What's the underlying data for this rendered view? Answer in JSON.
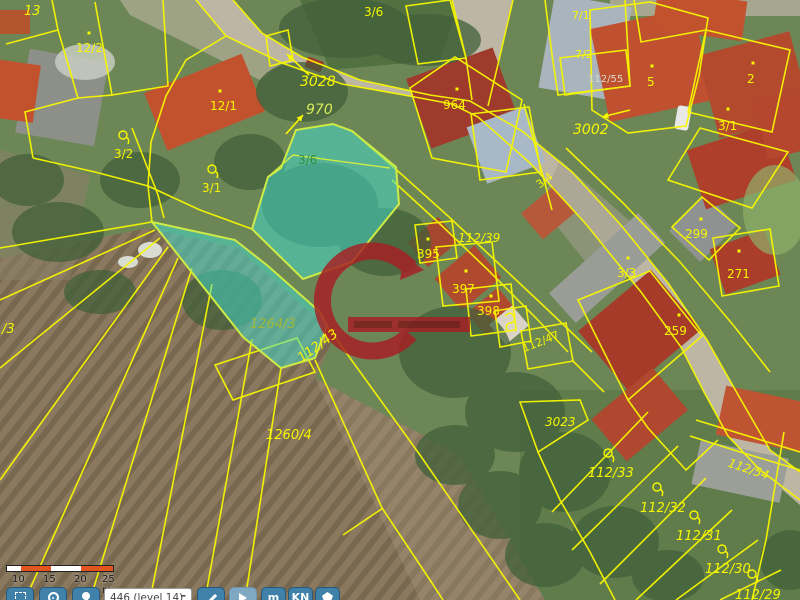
{
  "colors": {
    "parcel_line": "#f7f700",
    "highlight_fill": "#3fe0cf",
    "highlight_stroke": "#cdea45",
    "toolbar_button": "#3f81a8",
    "scalebar_orange": "#e2551f",
    "watermark_red": "#a81e23"
  },
  "scalebar": {
    "ticks": [
      "10",
      "15",
      "20",
      "25 m"
    ]
  },
  "toolbar": {
    "level_label": "446 (level 14)",
    "minus_label": "–",
    "m_label": "m",
    "kn_label": "KN"
  },
  "map": {
    "labels": [
      {
        "t": "13",
        "x": 24,
        "y": 2,
        "size": 13,
        "italic": true
      },
      {
        "t": "12/2",
        "x": 76,
        "y": 40,
        "size": 12,
        "dot": [
          89,
          33
        ]
      },
      {
        "t": "12/1",
        "x": 210,
        "y": 98,
        "size": 12,
        "dot": [
          220,
          91
        ]
      },
      {
        "t": "3/2",
        "x": 114,
        "y": 146,
        "size": 12,
        "balloon": [
          123,
          135
        ]
      },
      {
        "t": "3/1",
        "x": 202,
        "y": 180,
        "size": 12,
        "balloon": [
          212,
          169
        ]
      },
      {
        "t": "3/6",
        "x": 364,
        "y": 4,
        "size": 12
      },
      {
        "t": "3028",
        "x": 300,
        "y": 72,
        "size": 14,
        "italic": true
      },
      {
        "t": "970",
        "x": 306,
        "y": 100,
        "size": 14,
        "italic": true,
        "color": "#d8ea5c"
      },
      {
        "t": "3/6",
        "x": 298,
        "y": 152,
        "size": 12,
        "color": "#2f8f3a"
      },
      {
        "t": "964",
        "x": 443,
        "y": 97,
        "size": 12,
        "dot": [
          457,
          89
        ]
      },
      {
        "t": "7/1",
        "x": 572,
        "y": 8,
        "size": 11
      },
      {
        "t": "7/2",
        "x": 575,
        "y": 47,
        "size": 11
      },
      {
        "t": "112/55",
        "x": 588,
        "y": 72,
        "size": 10,
        "color": "#d9dcc9"
      },
      {
        "t": "5",
        "x": 647,
        "y": 74,
        "size": 12,
        "dot": [
          652,
          66
        ]
      },
      {
        "t": "2",
        "x": 747,
        "y": 71,
        "size": 12,
        "dot": [
          753,
          63
        ]
      },
      {
        "t": "3/1",
        "x": 718,
        "y": 118,
        "size": 12,
        "dot": [
          728,
          109
        ]
      },
      {
        "t": "3002",
        "x": 573,
        "y": 120,
        "size": 14,
        "italic": true
      },
      {
        "t": "3/4",
        "x": 533,
        "y": 180,
        "size": 11,
        "rot": -38
      },
      {
        "t": "112/39",
        "x": 458,
        "y": 230,
        "size": 12,
        "italic": true
      },
      {
        "t": "395",
        "x": 417,
        "y": 246,
        "size": 12,
        "dot": [
          428,
          239
        ]
      },
      {
        "t": "397",
        "x": 452,
        "y": 281,
        "size": 12,
        "dot": [
          466,
          271
        ]
      },
      {
        "t": "398",
        "x": 477,
        "y": 303,
        "size": 12,
        "dot": [
          491,
          296
        ]
      },
      {
        "t": "3/3",
        "x": 617,
        "y": 265,
        "size": 12,
        "dot": [
          628,
          258
        ]
      },
      {
        "t": "299",
        "x": 685,
        "y": 226,
        "size": 12,
        "dot": [
          701,
          219
        ]
      },
      {
        "t": "271",
        "x": 727,
        "y": 266,
        "size": 12,
        "dot": [
          739,
          251
        ]
      },
      {
        "t": "259",
        "x": 664,
        "y": 323,
        "size": 12,
        "dot": [
          679,
          315
        ]
      },
      {
        "t": "112/47",
        "x": 520,
        "y": 342,
        "size": 11,
        "rot": -22
      },
      {
        "t": "112/54",
        "x": 731,
        "y": 455,
        "size": 12,
        "italic": true,
        "rot": 18
      },
      {
        "t": "1264/3",
        "x": 250,
        "y": 315,
        "size": 13,
        "italic": true,
        "color": "#9fb937"
      },
      {
        "t": "112/43",
        "x": 294,
        "y": 352,
        "size": 13,
        "italic": true,
        "rot": -36
      },
      {
        "t": "/3",
        "x": 2,
        "y": 320,
        "size": 13,
        "italic": true
      },
      {
        "t": "1260/4",
        "x": 266,
        "y": 426,
        "size": 13,
        "italic": true
      },
      {
        "t": "3023",
        "x": 545,
        "y": 414,
        "size": 12,
        "italic": true
      },
      {
        "t": "112/33",
        "x": 588,
        "y": 464,
        "size": 13,
        "italic": true,
        "balloon": [
          608,
          453
        ]
      },
      {
        "t": "112/32",
        "x": 640,
        "y": 499,
        "size": 13,
        "italic": true,
        "balloon": [
          657,
          487
        ]
      },
      {
        "t": "112/31",
        "x": 676,
        "y": 527,
        "size": 13,
        "italic": true,
        "balloon": [
          694,
          515
        ]
      },
      {
        "t": "112/30",
        "x": 705,
        "y": 560,
        "size": 13,
        "italic": true,
        "balloon": [
          722,
          549
        ]
      },
      {
        "t": "112/29",
        "x": 735,
        "y": 586,
        "size": 13,
        "italic": true,
        "balloon": [
          752,
          574
        ]
      }
    ],
    "arrows": [
      {
        "x1": 309,
        "y1": 75,
        "x2": 287,
        "y2": 54
      },
      {
        "x1": 286,
        "y1": 134,
        "x2": 303,
        "y2": 115
      },
      {
        "x1": 630,
        "y1": 110,
        "x2": 602,
        "y2": 117
      }
    ],
    "symbols": [
      {
        "x": 505,
        "y": 316,
        "kind": "land-use-symbol"
      }
    ]
  }
}
